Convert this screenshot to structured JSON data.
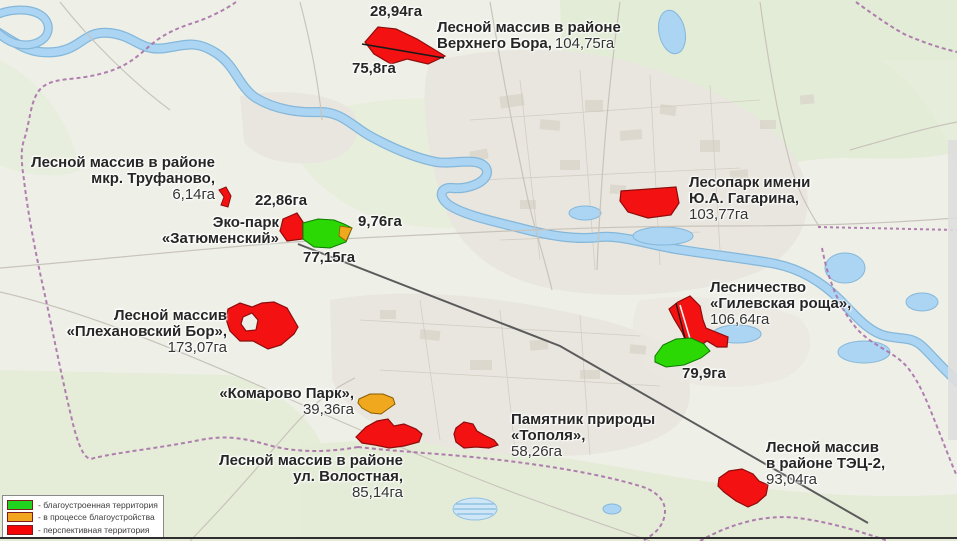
{
  "legend": {
    "items": [
      {
        "swatch_color": "#1fd31f",
        "label": "- благоустроенная территория"
      },
      {
        "swatch_color": "#f2a51f",
        "label": "- в процессе благоустройства"
      },
      {
        "swatch_color": "#f50505",
        "label": "- перспективная территория"
      }
    ]
  },
  "status_colors": {
    "green": "#2bd804",
    "orange": "#f0a81e",
    "red": "#f31111"
  },
  "areas": [
    {
      "id": "verkhny-bor",
      "lines": [
        "Лесной массив в районе",
        "Верхнего Бора,"
      ],
      "value": "104,75га",
      "value_top": "28,94га",
      "value_bottom": "75,8га"
    },
    {
      "id": "trufanovo",
      "lines": [
        "Лесной массив в районе",
        "мкр. Труфаново,"
      ],
      "value": "6,14га"
    },
    {
      "id": "zatyumensky",
      "lines": [
        "Эко-парк",
        "«Затюменский»"
      ],
      "value_red": "22,86га",
      "value_orange": "9,76га",
      "value_green": "77,15га"
    },
    {
      "id": "gagarin",
      "lines": [
        "Лесопарк имени",
        "Ю.А. Гагарина,"
      ],
      "value": "103,77га"
    },
    {
      "id": "gilevskaya",
      "lines": [
        "Лесничество",
        "«Гилевская роща»,"
      ],
      "value": "106,64га",
      "value_green": "79,9га"
    },
    {
      "id": "plekhanovsky",
      "lines": [
        "Лесной массив",
        "«Плехановский Бор»,"
      ],
      "value": "173,07га"
    },
    {
      "id": "komarovo",
      "lines": [
        "«Комарово Парк»,"
      ],
      "value": "39,36га"
    },
    {
      "id": "volostnaya",
      "lines": [
        "Лесной массив в районе",
        "ул. Волостная,"
      ],
      "value": "85,14га"
    },
    {
      "id": "topolya",
      "lines": [
        "Памятник природы",
        "«Тополя»,"
      ],
      "value": "58,26га"
    },
    {
      "id": "tec2",
      "lines": [
        "Лесной массив",
        "в районе ТЭЦ-2,"
      ],
      "value": "93,04га"
    }
  ]
}
